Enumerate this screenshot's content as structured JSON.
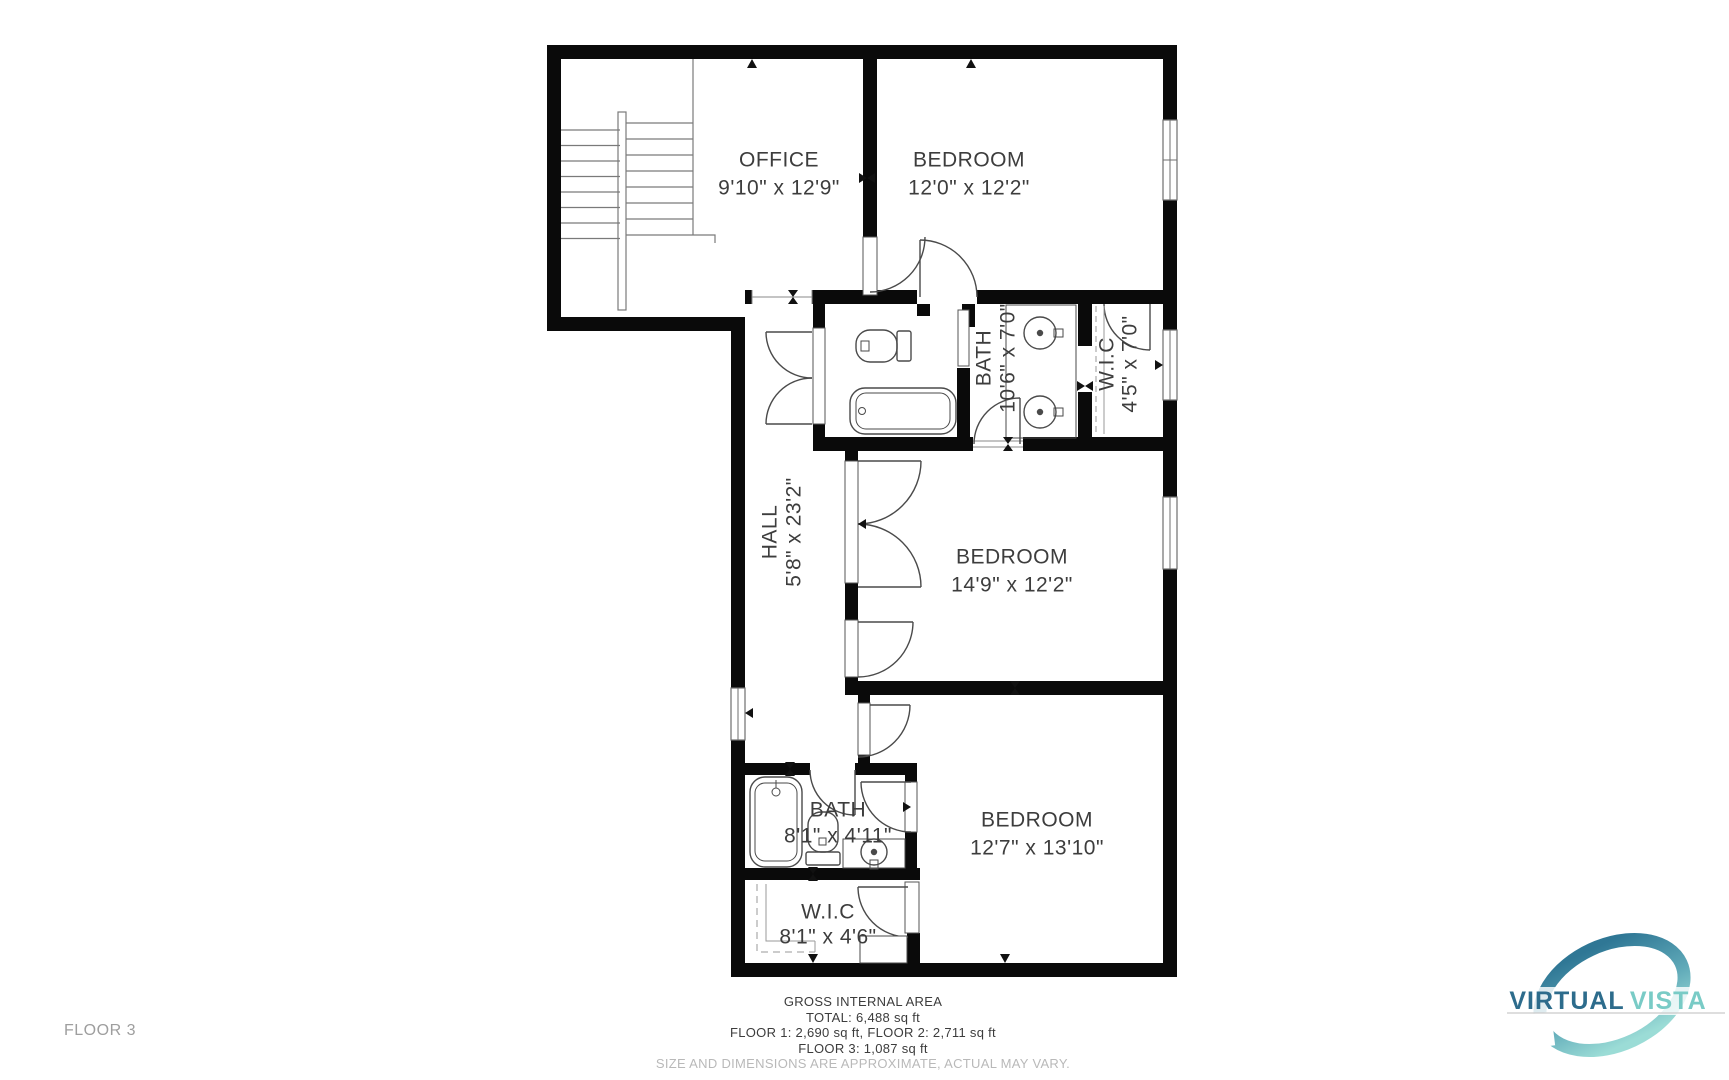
{
  "plan": {
    "rooms": {
      "office": {
        "label": "OFFICE",
        "dims": "9'10\" x 12'9\""
      },
      "bedroom_top": {
        "label": "BEDROOM",
        "dims": "12'0\" x 12'2\""
      },
      "bath_top": {
        "label": "BATH",
        "dims": "10'6\" x 7'0\""
      },
      "wic_top": {
        "label": "W.I.C",
        "dims": "4'5\" x 7'0\""
      },
      "hall": {
        "label": "HALL",
        "dims": "5'8\" x 23'2\""
      },
      "bedroom_mid": {
        "label": "BEDROOM",
        "dims": "14'9\" x 12'2\""
      },
      "bedroom_bottom": {
        "label": "BEDROOM",
        "dims": "12'7\" x 13'10\""
      },
      "bath_bottom": {
        "label": "BATH",
        "dims": "8'1\" x 4'11\""
      },
      "wic_bottom": {
        "label": "W.I.C",
        "dims": "8'1\" x 4'6\""
      }
    },
    "floor_label": "FLOOR 3"
  },
  "footer": {
    "title": "GROSS INTERNAL AREA",
    "total": "TOTAL: 6,488 sq ft",
    "floors_1_2": "FLOOR 1: 2,690 sq ft, FLOOR 2: 2,711 sq ft",
    "floor_3": "FLOOR 3: 1,087 sq ft",
    "disclaimer": "SIZE AND DIMENSIONS ARE APPROXIMATE, ACTUAL MAY VARY."
  },
  "logo": {
    "word1": "VIRTUAL",
    "word2": "VISTA",
    "color_primary": "#2e6f8e",
    "color_secondary": "#7accc8"
  }
}
